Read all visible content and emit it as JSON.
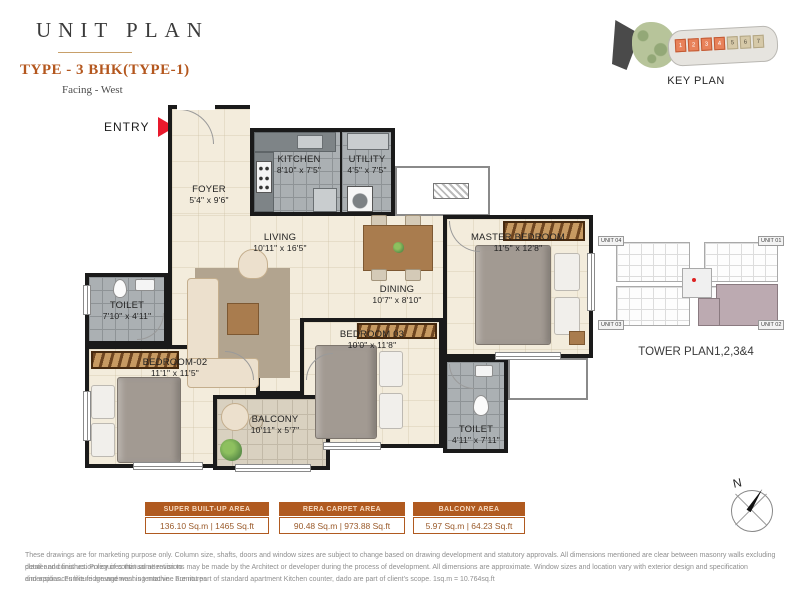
{
  "header": {
    "title": "UNIT PLAN",
    "type_label": "TYPE - 3 BHK(TYPE-1)",
    "facing": "Facing - West",
    "entry_label": "ENTRY"
  },
  "key_plan": {
    "label": "KEY PLAN",
    "orange_units": [
      "1",
      "2",
      "3",
      "4"
    ],
    "grey_units": [
      "5",
      "6",
      "7"
    ]
  },
  "tower_plan": {
    "label": "TOWER PLAN1,2,3&4",
    "units": [
      "UNIT 04",
      "UNIT 01",
      "UNIT 03",
      "UNIT 02"
    ]
  },
  "compass": {
    "north_label": "N"
  },
  "rooms": [
    {
      "name": "FOYER",
      "dims": "5'4\" x 9'6\""
    },
    {
      "name": "KITCHEN",
      "dims": "8'10\" x 7'5\""
    },
    {
      "name": "UTILITY",
      "dims": "4'5\" x 7'5\""
    },
    {
      "name": "LIVING",
      "dims": "10'11\" x 16'5\""
    },
    {
      "name": "DINING",
      "dims": "10'7\" x 8'10\""
    },
    {
      "name": "MASTER BEDROOM",
      "dims": "11'5\" x 12'8\""
    },
    {
      "name": "TOILET",
      "dims": "7'10\" x 4'11\""
    },
    {
      "name": "BEDROOM-02",
      "dims": "11'1\" x 11'5\""
    },
    {
      "name": "BEDROOM 03",
      "dims": "10'0\" x 11'8\""
    },
    {
      "name": "BALCONY",
      "dims": "10'11\" x 5'7\""
    },
    {
      "name": "TOILET",
      "dims": "4'11\" x 7'11\""
    }
  ],
  "area_tables": [
    {
      "header": "SUPER BUILT-UP AREA",
      "value": "136.10 Sq.m  |  1465 Sq.ft"
    },
    {
      "header": "RERA CARPET AREA",
      "value": "90.48 Sq.m  |  973.88 Sq.ft"
    },
    {
      "header": "BALCONY AREA",
      "value": "5.97 Sq.m  |  64.23 Sq.ft"
    }
  ],
  "disclaimer": {
    "lines": [
      "These drawings are for marketing purpose only. Column size, shafts, doors and window sizes are subject to change based on drawing development and statutory approvals. All dimensions mentioned are clear between masonry walls excluding plaster and finishes.  Policy of continual attention to",
      "detail and construction requires that some revisions may be made by the Architect or developer during the process of  development.  All dimensions are approximate. Window sizes and location vary with exterior design and specification dimensions.  Furniture arrangement is tentative .  Furnitures",
      "and appliances like fridge and washing machine are not part of standard apartment Kitchen counter, dado are part of client's scope. 1sq.m = 10.764sq.ft"
    ]
  },
  "colors": {
    "accent": "#b4571e",
    "table_header_bg": "#b05a20",
    "entry_arrow_red": "#e8192c",
    "wall": "#1a1a1a",
    "floor_cream": "#f3ecdc",
    "floor_tile_grey": "#abb0b3",
    "floor_balcony": "#d9d1c0",
    "keyplan_highlight_orange": "#e8825a",
    "tower_highlight_mauve": "#bcaab1"
  }
}
